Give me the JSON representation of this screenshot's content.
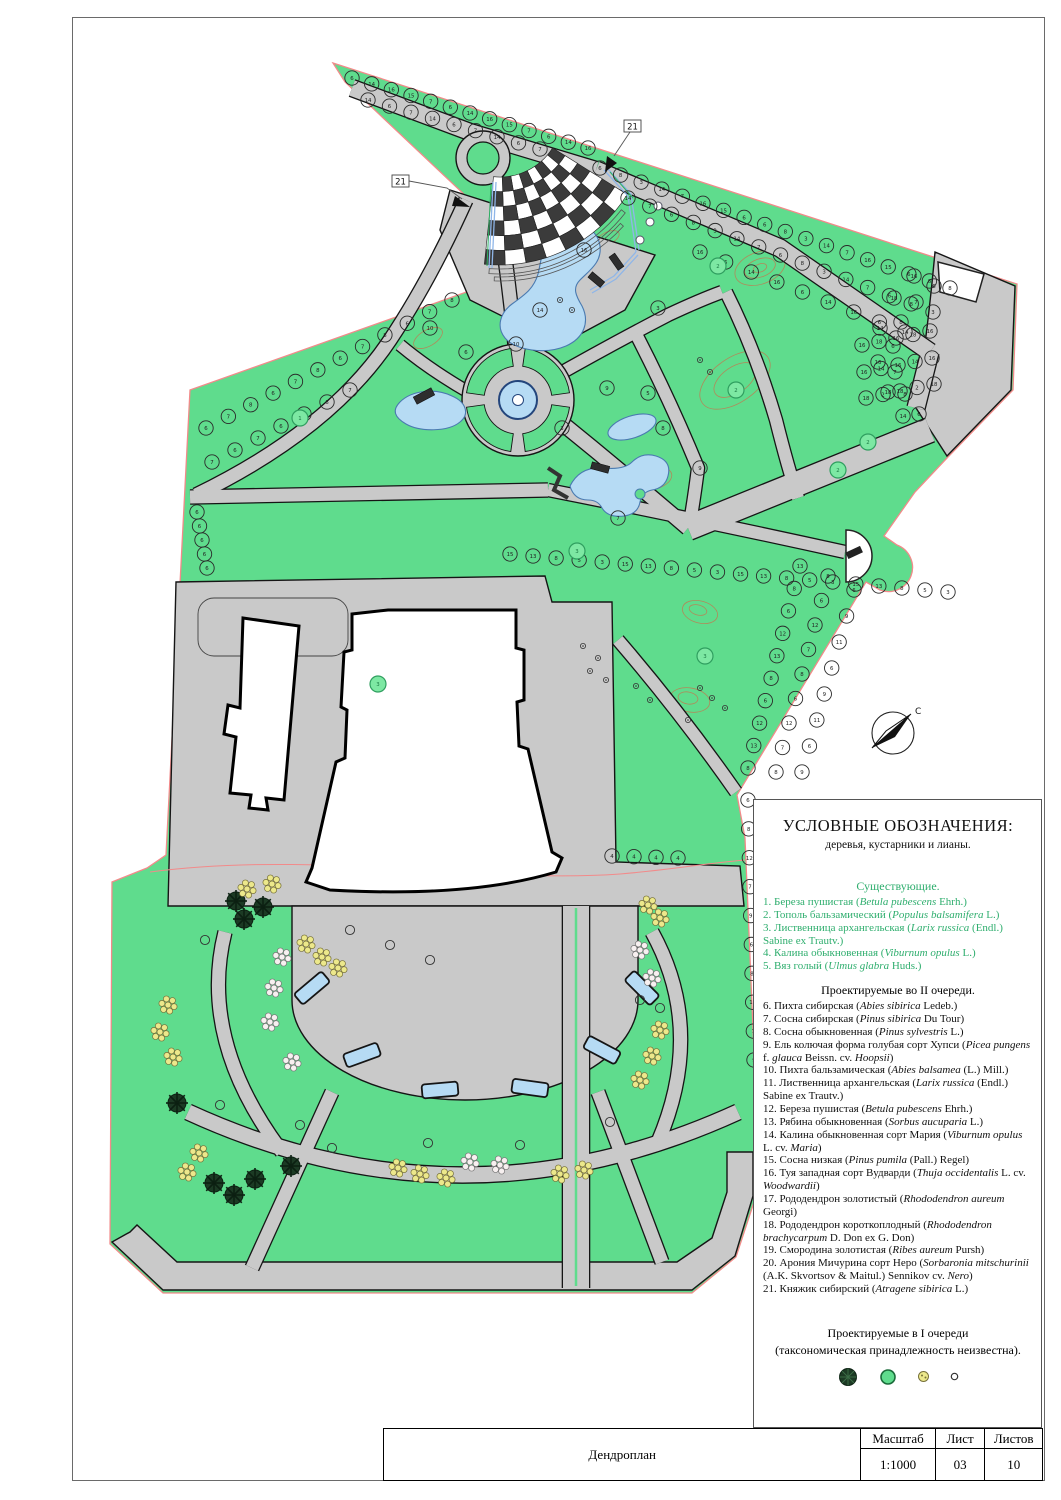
{
  "colors": {
    "green": "#5fdc8d",
    "green-light": "#7de8a3",
    "gray": "#c9c9c9",
    "ink": "#151515",
    "water": "#b6dbf4",
    "water-edge": "#4a7ab0",
    "red": "#f28a8a",
    "yellow": "#ece88b",
    "dark-tree": "#1c3a24",
    "legend-green": "#2fae6e",
    "checker": "#3b3b3b",
    "contour": "#b08a5a",
    "trellis": "#8fb6e8"
  },
  "legend": {
    "title": "УСЛОВНЫЕ ОБОЗНАЧЕНИЯ:",
    "subtitle": "деревья, кустарники и лианы.",
    "existing_header": "Существующие.",
    "existing": [
      "1. Береза пушистая (*Betula pubescens* Ehrh.)",
      "2. Тополь бальзамический (*Populus balsamifera* L.)",
      "3. Лиственница архангельская (*Larix russica* (Endl.) Sabine ex Trautv.)",
      "4. Калина обыкновенная (*Viburnum opulus* L.)",
      "5. Вяз голый (*Ulmus glabra* Huds.)"
    ],
    "proposed2_header": "Проектируемые во II очереди.",
    "proposed2": [
      "6. Пихта сибирская (*Abies sibirica* Ledeb.)",
      "7. Сосна сибирская (*Pinus sibirica* Du Tour)",
      "8. Сосна обыкновенная (*Pinus sylvestris* L.)",
      "9. Ель колючая форма голубая сорт Хупси (*Picea pungens* f. *glauca* Beissn. cv. *Hoopsii*)",
      "10. Пихта бальзамическая (*Abies balsamea* (L.) Mill.)",
      "11. Лиственница архангельская (*Larix russica* (Endl.) Sabine ex Trautv.)",
      "12. Береза пушистая (*Betula pubescens* Ehrh.)",
      "13. Рябина обыкновенная (*Sorbus aucuparia* L.)",
      "14. Калина обыкновенная сорт Мария (*Viburnum opulus* L. cv. *Maria*)",
      "15. Сосна низкая (*Pinus pumila* (Pall.) Regel)",
      "16. Туя западная сорт Вудварди (*Thuja occidentalis* L. cv. *Woodwardii*)",
      "17. Рододендрон золотистый (*Rhododendron aureum* Georgi)",
      "18. Рододендрон короткоплодный (*Rhododendron brachycarpum* D. Don ex G. Don)",
      "19. Смородина золотистая (*Ribes aureum* Pursh)",
      "20. Арония Мичурина сорт Неро (*Sorbaronia mitschurinii* (A.K. Skvortsov & Maitul.) Sennikov cv. *Nero*)",
      "21. Княжик сибирский (*Atragene sibirica* L.)"
    ],
    "proposed1_line1": "Проектируемые в I очереди",
    "proposed1_line2": "(таксономическая принадлежность неизвестна)."
  },
  "titleblock": {
    "drawing_title": "Дендроплан",
    "scale_label": "Масштаб",
    "scale_value": "1:1000",
    "sheet_label": "Лист",
    "sheet_number": "03",
    "sheets_label": "Листов",
    "sheets_total": "10"
  },
  "map": {
    "callout_label": "21",
    "compass_label": "С",
    "checker": {
      "cx": 500,
      "cy": 115,
      "r0": 62,
      "r1": 150,
      "a0": 32,
      "a1": 96,
      "nr": 6,
      "na": 8
    },
    "fountain": {
      "cx": 518,
      "cy": 400,
      "r0": 34,
      "r1": 52
    },
    "tree_rows": [
      {
        "a": [
          352,
          78
        ],
        "b": [
          588,
          148
        ],
        "n": 13,
        "labels": [
          6,
          14,
          16,
          15,
          7
        ]
      },
      {
        "a": [
          368,
          100
        ],
        "b": [
          540,
          149
        ],
        "n": 9,
        "labels": [
          14,
          6,
          7
        ]
      },
      {
        "a": [
          600,
          168
        ],
        "b": [
          950,
          288
        ],
        "n": 18,
        "labels": [
          6,
          8,
          3,
          14,
          7,
          16,
          15,
          6
        ]
      },
      {
        "a": [
          628,
          198
        ],
        "b": [
          933,
          312
        ],
        "n": 15,
        "labels": [
          14,
          7,
          6,
          8,
          3
        ]
      },
      {
        "a": [
          700,
          252
        ],
        "b": [
          905,
          332
        ],
        "n": 9,
        "labels": [
          16,
          6,
          14
        ]
      },
      {
        "a": [
          206,
          428
        ],
        "b": [
          452,
          300
        ],
        "n": 12,
        "labels": [
          6,
          7,
          8
        ]
      },
      {
        "a": [
          212,
          462
        ],
        "b": [
          350,
          390
        ],
        "n": 7,
        "labels": [
          7,
          6
        ]
      },
      {
        "a": [
          197,
          512
        ],
        "b": [
          207,
          568
        ],
        "n": 5,
        "labels": [
          6
        ]
      },
      {
        "a": [
          510,
          554
        ],
        "b": [
          948,
          592
        ],
        "n": 20,
        "labels": [
          15,
          13,
          8,
          5,
          3
        ]
      },
      {
        "a": [
          800,
          566
        ],
        "b": [
          748,
          768
        ],
        "n": 10,
        "labels": [
          13,
          8,
          6,
          12
        ]
      },
      {
        "a": [
          828,
          576
        ],
        "b": [
          776,
          772
        ],
        "n": 9,
        "labels": [
          8,
          6,
          12,
          7
        ]
      },
      {
        "a": [
          854,
          590
        ],
        "b": [
          802,
          772
        ],
        "n": 8,
        "labels": [
          6,
          9,
          11
        ]
      },
      {
        "a": [
          748,
          800
        ],
        "b": [
          754,
          1060
        ],
        "n": 10,
        "labels": [
          6,
          8,
          12,
          7,
          9
        ]
      },
      {
        "a": [
          612,
          856
        ],
        "b": [
          678,
          858
        ],
        "n": 4,
        "labels": [
          4
        ]
      },
      {
        "pts": [
          [
            934,
            286
          ],
          [
            916,
            302
          ],
          [
            901,
            322
          ],
          [
            893,
            346
          ],
          [
            895,
            372
          ],
          [
            905,
            394
          ],
          [
            919,
            414
          ]
        ],
        "labels": [
          6,
          7,
          8
        ]
      },
      {
        "pts": [
          [
            914,
            276
          ],
          [
            894,
            298
          ],
          [
            880,
            328
          ],
          [
            878,
            362
          ],
          [
            888,
            392
          ],
          [
            903,
            416
          ]
        ],
        "labels": [
          16,
          18,
          14
        ]
      },
      {
        "a": [
          862,
          345
        ],
        "b": [
          930,
          331
        ],
        "n": 5,
        "labels": [
          16,
          18
        ]
      },
      {
        "a": [
          864,
          372
        ],
        "b": [
          932,
          358
        ],
        "n": 5,
        "labels": [
          16,
          14
        ]
      },
      {
        "a": [
          866,
          398
        ],
        "b": [
          934,
          384
        ],
        "n": 5,
        "labels": [
          18,
          2
        ]
      }
    ],
    "singles": [
      {
        "x": 607,
        "y": 388,
        "l": 9
      },
      {
        "x": 648,
        "y": 393,
        "l": 5
      },
      {
        "x": 562,
        "y": 428,
        "l": 3
      },
      {
        "x": 663,
        "y": 428,
        "l": 8
      },
      {
        "x": 700,
        "y": 468,
        "l": 9
      },
      {
        "x": 618,
        "y": 518,
        "l": 7
      },
      {
        "x": 430,
        "y": 328,
        "l": 10
      },
      {
        "x": 516,
        "y": 344,
        "l": 10
      },
      {
        "x": 658,
        "y": 308,
        "l": 3
      },
      {
        "x": 466,
        "y": 352,
        "l": 6
      },
      {
        "x": 584,
        "y": 250,
        "l": 16
      },
      {
        "x": 540,
        "y": 310,
        "l": 14
      },
      {
        "x": 718,
        "y": 266,
        "l": 2,
        "g": 1
      },
      {
        "x": 736,
        "y": 390,
        "l": 2,
        "g": 1
      },
      {
        "x": 838,
        "y": 470,
        "l": 2,
        "g": 1
      },
      {
        "x": 378,
        "y": 684,
        "l": 3,
        "g": 1
      },
      {
        "x": 705,
        "y": 656,
        "l": 3,
        "g": 1
      },
      {
        "x": 577,
        "y": 551,
        "l": 3,
        "g": 1
      },
      {
        "x": 868,
        "y": 442,
        "l": 2,
        "g": 1
      },
      {
        "x": 300,
        "y": 418,
        "l": 1,
        "g": 1
      }
    ],
    "clusters": [
      {
        "t": "dark",
        "x": 236,
        "y": 901
      },
      {
        "t": "dark",
        "x": 263,
        "y": 907
      },
      {
        "t": "dark",
        "x": 244,
        "y": 919
      },
      {
        "t": "dark",
        "x": 177,
        "y": 1103
      },
      {
        "t": "dark",
        "x": 214,
        "y": 1183
      },
      {
        "t": "dark",
        "x": 234,
        "y": 1195
      },
      {
        "t": "dark",
        "x": 255,
        "y": 1179
      },
      {
        "t": "dark",
        "x": 291,
        "y": 1166
      },
      {
        "t": "yellow",
        "x": 247,
        "y": 889
      },
      {
        "t": "yellow",
        "x": 272,
        "y": 884
      },
      {
        "t": "yellow",
        "x": 168,
        "y": 1005
      },
      {
        "t": "yellow",
        "x": 160,
        "y": 1032
      },
      {
        "t": "yellow",
        "x": 173,
        "y": 1057
      },
      {
        "t": "yellow",
        "x": 199,
        "y": 1153
      },
      {
        "t": "yellow",
        "x": 187,
        "y": 1172
      },
      {
        "t": "yellow",
        "x": 306,
        "y": 944
      },
      {
        "t": "yellow",
        "x": 322,
        "y": 957
      },
      {
        "t": "yellow",
        "x": 338,
        "y": 968
      },
      {
        "t": "yellow",
        "x": 398,
        "y": 1168
      },
      {
        "t": "yellow",
        "x": 420,
        "y": 1174
      },
      {
        "t": "yellow",
        "x": 446,
        "y": 1178
      },
      {
        "t": "yellow",
        "x": 560,
        "y": 1174
      },
      {
        "t": "yellow",
        "x": 584,
        "y": 1170
      },
      {
        "t": "yellow",
        "x": 640,
        "y": 1080
      },
      {
        "t": "yellow",
        "x": 652,
        "y": 1056
      },
      {
        "t": "yellow",
        "x": 660,
        "y": 1030
      },
      {
        "t": "yellow",
        "x": 648,
        "y": 905
      },
      {
        "t": "yellow",
        "x": 660,
        "y": 918
      },
      {
        "t": "white",
        "x": 282,
        "y": 957
      },
      {
        "t": "white",
        "x": 274,
        "y": 988
      },
      {
        "t": "white",
        "x": 270,
        "y": 1022
      },
      {
        "t": "white",
        "x": 292,
        "y": 1062
      },
      {
        "t": "white",
        "x": 470,
        "y": 1162
      },
      {
        "t": "white",
        "x": 500,
        "y": 1165
      },
      {
        "t": "white",
        "x": 640,
        "y": 950
      },
      {
        "t": "white",
        "x": 652,
        "y": 978
      },
      {
        "t": "open",
        "x": 205,
        "y": 940
      },
      {
        "t": "open",
        "x": 220,
        "y": 1105
      },
      {
        "t": "open",
        "x": 350,
        "y": 930
      },
      {
        "t": "open",
        "x": 300,
        "y": 1125
      },
      {
        "t": "open",
        "x": 332,
        "y": 1148
      },
      {
        "t": "open",
        "x": 428,
        "y": 1143
      },
      {
        "t": "open",
        "x": 520,
        "y": 1145
      },
      {
        "t": "open",
        "x": 610,
        "y": 1122
      },
      {
        "t": "open",
        "x": 640,
        "y": 1000
      },
      {
        "t": "open",
        "x": 660,
        "y": 1008
      },
      {
        "t": "open",
        "x": 390,
        "y": 945
      },
      {
        "t": "open",
        "x": 430,
        "y": 960
      },
      {
        "t": "dot",
        "x": 583,
        "y": 646
      },
      {
        "t": "dot",
        "x": 598,
        "y": 658
      },
      {
        "t": "dot",
        "x": 590,
        "y": 671
      },
      {
        "t": "dot",
        "x": 606,
        "y": 680
      },
      {
        "t": "dot",
        "x": 700,
        "y": 688
      },
      {
        "t": "dot",
        "x": 712,
        "y": 698
      },
      {
        "t": "dot",
        "x": 725,
        "y": 708
      },
      {
        "t": "dot",
        "x": 688,
        "y": 720
      },
      {
        "t": "dot",
        "x": 650,
        "y": 700
      },
      {
        "t": "dot",
        "x": 636,
        "y": 686
      },
      {
        "t": "dot",
        "x": 560,
        "y": 300
      },
      {
        "t": "dot",
        "x": 572,
        "y": 310
      },
      {
        "t": "dot",
        "x": 700,
        "y": 360
      },
      {
        "t": "dot",
        "x": 710,
        "y": 372
      }
    ],
    "beds": [
      {
        "x": 312,
        "y": 988,
        "rot": -40
      },
      {
        "x": 362,
        "y": 1055,
        "rot": -20
      },
      {
        "x": 440,
        "y": 1090,
        "rot": -5
      },
      {
        "x": 530,
        "y": 1088,
        "rot": 8
      },
      {
        "x": 602,
        "y": 1050,
        "rot": 28
      },
      {
        "x": 642,
        "y": 988,
        "rot": 45
      }
    ]
  }
}
